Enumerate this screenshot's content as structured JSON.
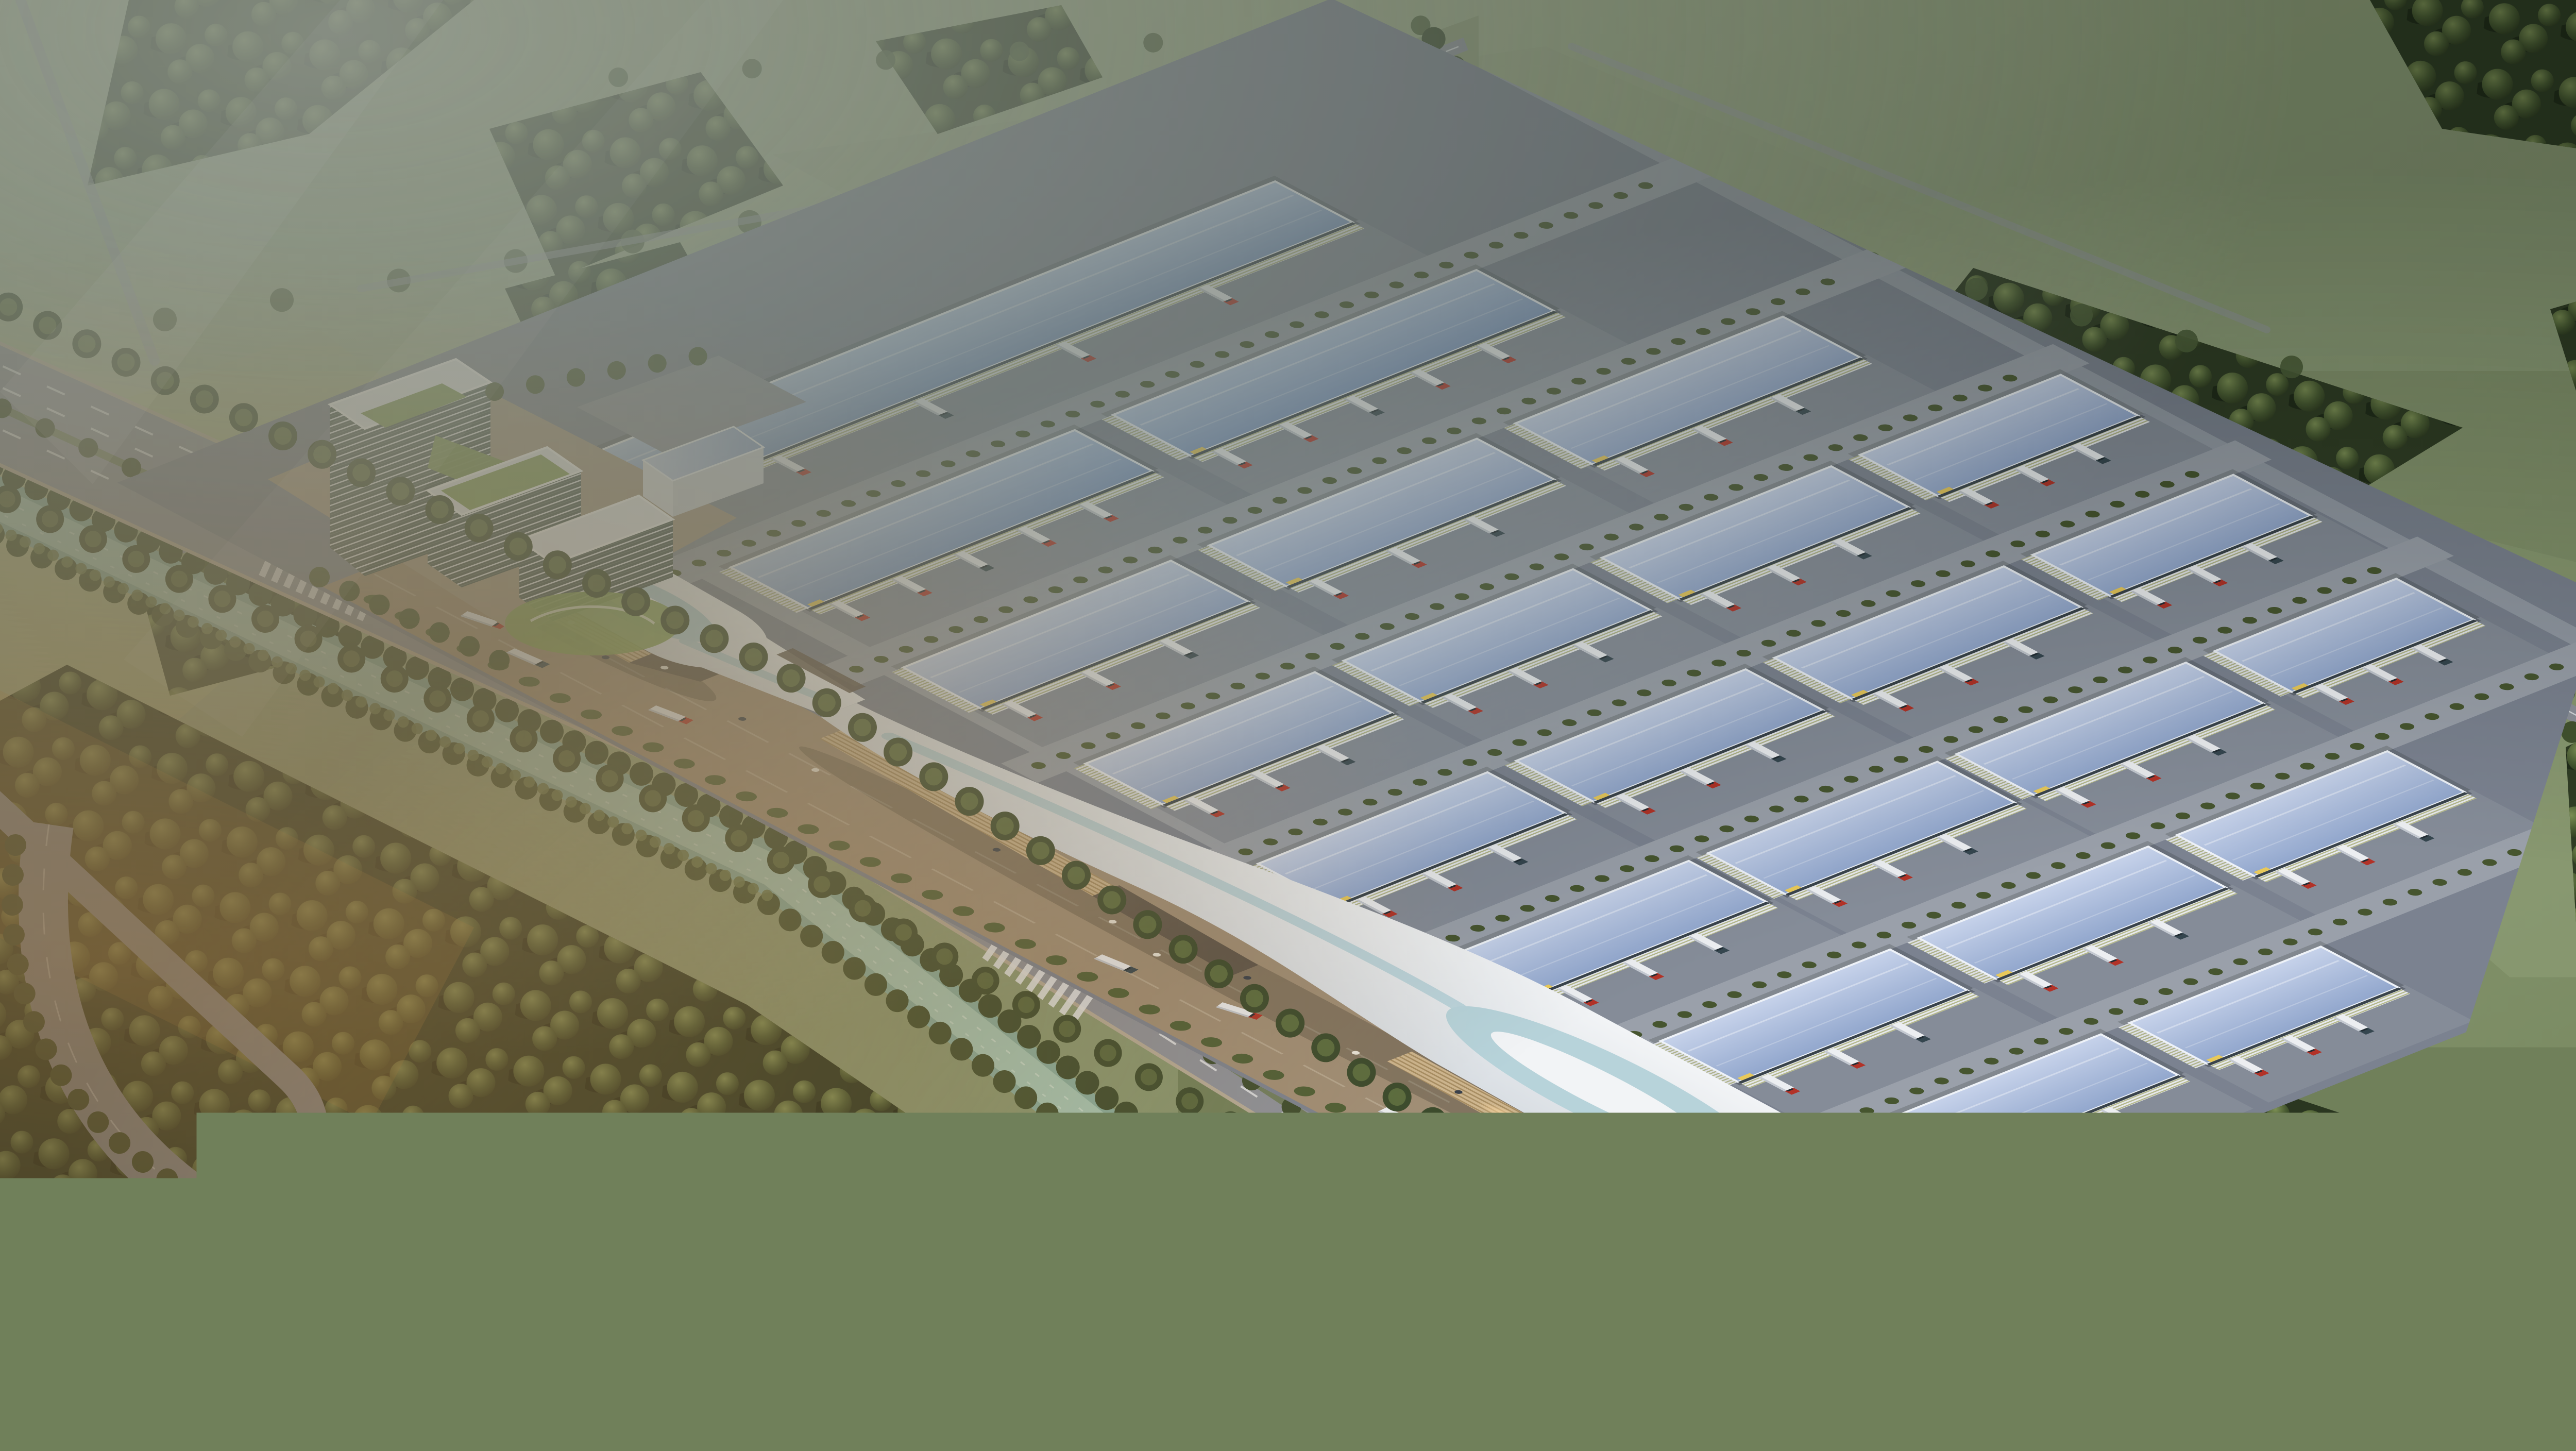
{
  "scene": {
    "type": "aerial architectural rendering",
    "subject": "logistics industrial park master plan",
    "setting": "flat farmland with forest belts, irrigation canal and tree-lined boulevard",
    "lighting": "hazy late-afternoon sunlight from the lower left",
    "view": "high oblique bird's-eye view"
  },
  "colors": {
    "field_light": "#b4bf9c",
    "field_mid": "#8d9c76",
    "field_dark": "#74855c",
    "forest_base": "#2f3c24",
    "tree_hi": "#7d9055",
    "tree_mid": "#4a5c33",
    "tree_dark": "#2c381f",
    "hedge": "#46552f",
    "road": "#8d919a",
    "road_dark": "#6e7278",
    "lane_marking": "#e9ebee",
    "canal_water": "#86ad9e",
    "canal_light": "#a9cab9",
    "platform": "#7b8290",
    "yard": "#858c98",
    "inner_street": "#9aa0aa",
    "plaza": "#a08e76",
    "roof_small": "#aebbd9",
    "roof_small_hi": "#c6d2ea",
    "roof_small_lo": "#92a7cd",
    "roof_long_hi": "#b5c8e6",
    "roof_long_lo": "#7e99c4",
    "roof_ridge": "#eef2f8",
    "wall_white": "#e7e9ec",
    "wall_stripe": "#b3b78b",
    "clerestory": "#39434b",
    "accent_yellow": "#e8c95a",
    "gateway_white": "#f2f4f6",
    "gateway_shade": "#d9dee3",
    "gateway_lens": "#b7d3da",
    "gateway_wall": "#cdb58e",
    "gateway_wall_dark": "#a78d62",
    "canopy_shadow": "#5e554a",
    "office_glass": "#4d5c55",
    "office_band": "#e8eaec",
    "terrace_green": "#7e9a52",
    "lawn_green": "#86a356",
    "truck_trailer": "#eceef1",
    "truck_cab_red": "#b23227",
    "truck_cab_dark": "#35464f",
    "haze": "#e2e8dc",
    "sun_glow": "#ffba6e"
  },
  "elements": {
    "gateway_halls": 2,
    "office_towers": 3,
    "annex_buildings": 1,
    "warehouses": 23,
    "truck_yards": 23,
    "trucks": 82,
    "cars": 4,
    "people": 14,
    "zebra_crossings": 3,
    "tree_lined_roads": 4,
    "canals": 1,
    "boulevard_lanes": 4
  }
}
